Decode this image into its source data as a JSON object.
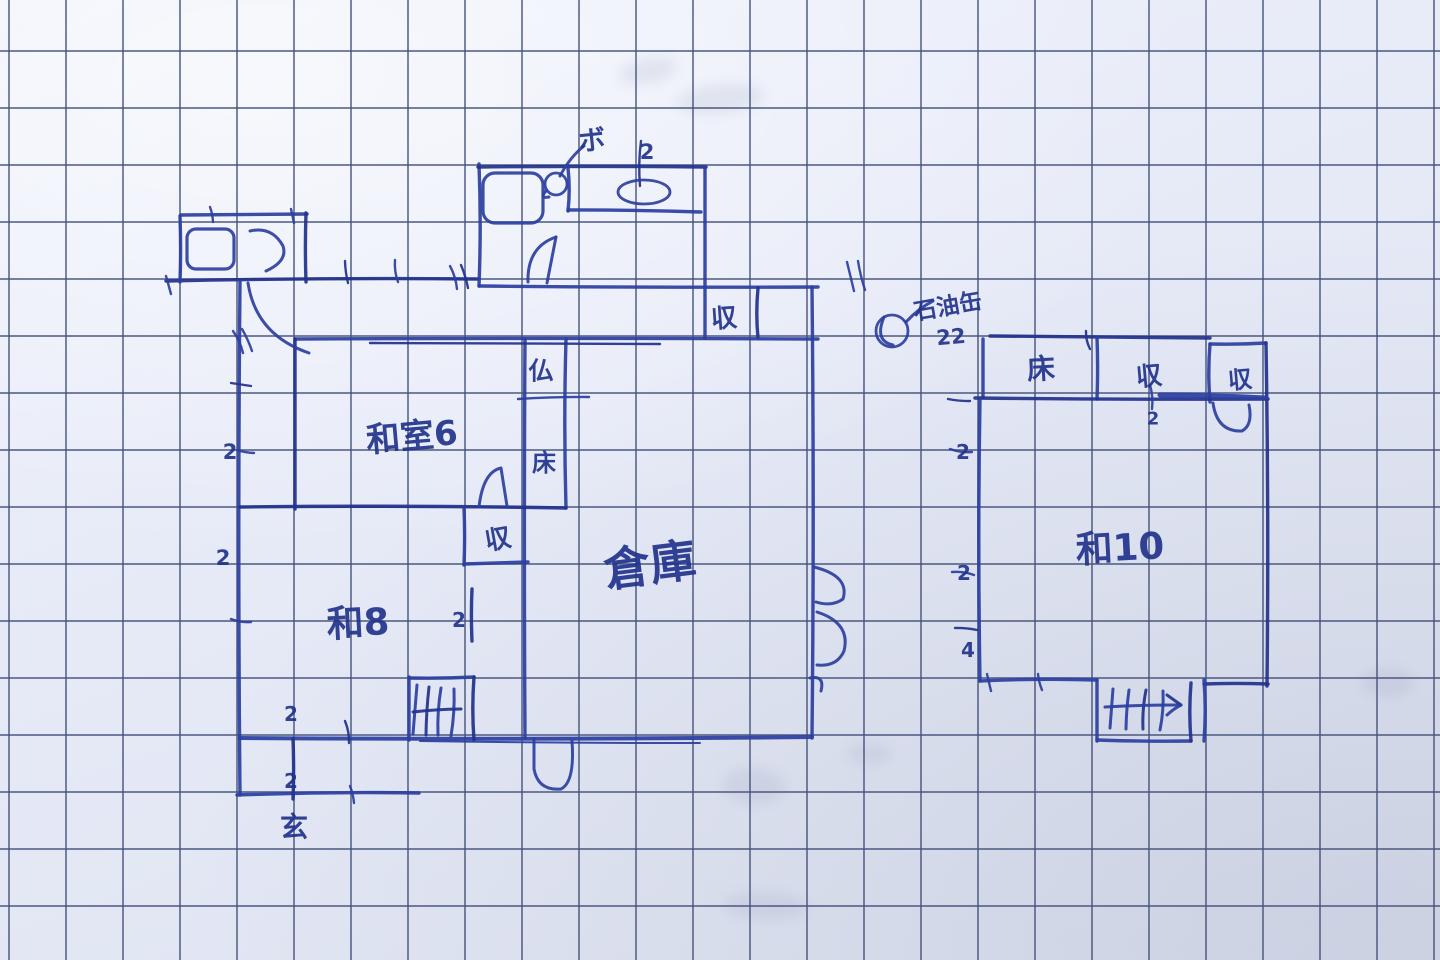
{
  "description": "Hand-drawn Japanese house floor plan sketched in blue ink on graph paper",
  "colors": {
    "ink": "#2c3fa0",
    "ink_dark": "#22338c",
    "grid": "#45527b",
    "bleed": "#8d98b6"
  },
  "grid": {
    "pitch": 57,
    "offset_x": 9,
    "offset_y": 51,
    "width": 1.7,
    "opacity": 0.82
  },
  "labels": [
    {
      "name": "boiler-note",
      "text": "ボ",
      "x": 592,
      "y": 141,
      "size": 27,
      "rot": -6
    },
    {
      "name": "dim-bath-top",
      "text": "2",
      "x": 647,
      "y": 152,
      "size": 21,
      "rot": 0
    },
    {
      "name": "closet-top-label",
      "text": "収",
      "x": 724,
      "y": 319,
      "size": 26,
      "rot": -4
    },
    {
      "name": "butsudan-label",
      "text": "仏",
      "x": 541,
      "y": 371,
      "size": 25,
      "rot": 0
    },
    {
      "name": "washitsu6-label",
      "text": "和室6",
      "x": 412,
      "y": 437,
      "size": 34,
      "rot": -5
    },
    {
      "name": "tokonoma-label",
      "text": "床",
      "x": 544,
      "y": 463,
      "size": 24,
      "rot": 0
    },
    {
      "name": "closet-mid-label",
      "text": "収",
      "x": 498,
      "y": 540,
      "size": 26,
      "rot": -10
    },
    {
      "name": "warehouse-label",
      "text": "倉庫",
      "x": 650,
      "y": 565,
      "size": 46,
      "rot": -7
    },
    {
      "name": "washitsu8-label",
      "text": "和8",
      "x": 358,
      "y": 623,
      "size": 37,
      "rot": -3
    },
    {
      "name": "dim-left-1",
      "text": "2",
      "x": 230,
      "y": 452,
      "size": 21,
      "rot": 0
    },
    {
      "name": "dim-left-2",
      "text": "2",
      "x": 223,
      "y": 558,
      "size": 21,
      "rot": 0
    },
    {
      "name": "dim-stair-left",
      "text": "2",
      "x": 459,
      "y": 620,
      "size": 20,
      "rot": 0
    },
    {
      "name": "dim-genkan-1",
      "text": "2",
      "x": 291,
      "y": 714,
      "size": 20,
      "rot": 0
    },
    {
      "name": "dim-genkan-2",
      "text": "2",
      "x": 291,
      "y": 781,
      "size": 20,
      "rot": 0
    },
    {
      "name": "genkan-label",
      "text": "玄",
      "x": 294,
      "y": 827,
      "size": 28,
      "rot": 0
    },
    {
      "name": "oilcan-note",
      "text": "石油缶",
      "x": 948,
      "y": 307,
      "size": 23,
      "rot": -10
    },
    {
      "name": "oilcan-qty",
      "text": "22",
      "x": 951,
      "y": 337,
      "size": 21,
      "rot": -5
    },
    {
      "name": "tokonoma-right-label",
      "text": "床",
      "x": 1041,
      "y": 369,
      "size": 28,
      "rot": -3
    },
    {
      "name": "closet-right1-label",
      "text": "収",
      "x": 1149,
      "y": 377,
      "size": 26,
      "rot": -5
    },
    {
      "name": "dim-closet-right",
      "text": "2",
      "x": 1153,
      "y": 419,
      "size": 18,
      "rot": 0
    },
    {
      "name": "closet-right2-label",
      "text": "収",
      "x": 1240,
      "y": 380,
      "size": 24,
      "rot": -5
    },
    {
      "name": "washitsu10-label",
      "text": "和10",
      "x": 1120,
      "y": 548,
      "size": 37,
      "rot": -3
    },
    {
      "name": "dim-right-1",
      "text": "2",
      "x": 963,
      "y": 452,
      "size": 20,
      "rot": 0
    },
    {
      "name": "dim-right-2",
      "text": "2",
      "x": 964,
      "y": 573,
      "size": 20,
      "rot": 0
    },
    {
      "name": "dim-right-3",
      "text": "4",
      "x": 968,
      "y": 650,
      "size": 20,
      "rot": 0
    }
  ],
  "sketch": {
    "walls": [
      [
        166,
        281,
        479,
        279
      ],
      [
        180,
        216,
        180,
        282
      ],
      [
        181,
        215,
        307,
        214
      ],
      [
        306,
        213,
        306,
        282
      ],
      [
        240,
        282,
        240,
        795
      ],
      [
        479,
        164,
        479,
        286
      ],
      [
        478,
        167,
        706,
        167
      ],
      [
        705,
        167,
        705,
        338
      ],
      [
        479,
        286,
        818,
        287
      ],
      [
        758,
        288,
        758,
        338
      ],
      [
        812,
        287,
        812,
        738
      ],
      [
        295,
        339,
        818,
        339
      ],
      [
        295,
        339,
        295,
        509
      ],
      [
        525,
        339,
        525,
        738
      ],
      [
        566,
        339,
        566,
        508
      ],
      [
        240,
        507,
        566,
        508
      ],
      [
        464,
        508,
        464,
        565
      ],
      [
        464,
        564,
        528,
        562
      ],
      [
        472,
        589,
        472,
        641
      ],
      [
        240,
        738,
        812,
        737,
        4
      ],
      [
        237,
        795,
        419,
        793
      ],
      [
        293,
        739,
        293,
        799
      ],
      [
        409,
        677,
        409,
        740
      ],
      [
        409,
        678,
        474,
        677
      ],
      [
        474,
        677,
        474,
        740
      ],
      [
        568,
        168,
        568,
        211
      ],
      [
        568,
        210,
        701,
        212
      ],
      [
        990,
        336,
        1210,
        338
      ],
      [
        1210,
        344,
        1266,
        343
      ],
      [
        1210,
        344,
        1210,
        402
      ],
      [
        1266,
        343,
        1267,
        686
      ],
      [
        1097,
        337,
        1097,
        399
      ],
      [
        983,
        339,
        983,
        397
      ],
      [
        975,
        398,
        1268,
        399
      ],
      [
        980,
        398,
        980,
        681
      ],
      [
        980,
        681,
        1097,
        680
      ],
      [
        1204,
        684,
        1268,
        684
      ],
      [
        1097,
        680,
        1097,
        741
      ],
      [
        1097,
        740,
        1191,
        741
      ],
      [
        1191,
        683,
        1191,
        741
      ],
      [
        1204,
        680,
        1204,
        741
      ],
      [
        1160,
        395,
        1266,
        398,
        5
      ],
      [
        370,
        343,
        660,
        344,
        2.4
      ],
      [
        420,
        741,
        700,
        743,
        2
      ]
    ],
    "ticks": [
      [
        210,
        207,
        213,
        222
      ],
      [
        291,
        209,
        294,
        223
      ],
      [
        345,
        261,
        348,
        283
      ],
      [
        395,
        260,
        398,
        282
      ],
      [
        450,
        266,
        457,
        289
      ],
      [
        461,
        265,
        468,
        288
      ],
      [
        847,
        262,
        854,
        291
      ],
      [
        858,
        261,
        865,
        290
      ],
      [
        641,
        141,
        640,
        186
      ],
      [
        233,
        331,
        243,
        353
      ],
      [
        242,
        329,
        252,
        351
      ],
      [
        231,
        383,
        251,
        386
      ],
      [
        237,
        450,
        254,
        453
      ],
      [
        231,
        619,
        251,
        622
      ],
      [
        345,
        721,
        349,
        743
      ],
      [
        350,
        786,
        354,
        803
      ],
      [
        166,
        276,
        171,
        294
      ],
      [
        948,
        399,
        970,
        401
      ],
      [
        950,
        449,
        972,
        452
      ],
      [
        952,
        572,
        974,
        575
      ],
      [
        955,
        628,
        977,
        630
      ],
      [
        987,
        674,
        991,
        691
      ],
      [
        1038,
        674,
        1042,
        690
      ],
      [
        1086,
        331,
        1090,
        349
      ],
      [
        1150,
        385,
        1152,
        409
      ],
      [
        518,
        399,
        589,
        397
      ]
    ],
    "hatches": [
      [
        417,
        685,
        413,
        734
      ],
      [
        429,
        687,
        426,
        735
      ],
      [
        441,
        688,
        438,
        735
      ],
      [
        454,
        689,
        451,
        736
      ],
      [
        413,
        712,
        461,
        709
      ],
      [
        1113,
        689,
        1110,
        728
      ],
      [
        1129,
        690,
        1126,
        729
      ],
      [
        1146,
        690,
        1143,
        729
      ],
      [
        1163,
        691,
        1160,
        730
      ],
      [
        1105,
        707,
        1181,
        705
      ],
      [
        1181,
        705,
        1167,
        695
      ],
      [
        1181,
        705,
        1167,
        715
      ]
    ],
    "paths": [
      {
        "name": "toilet-door-arc",
        "d": "M250,231 Q272,226 283,246 Q288,261 266,271"
      },
      {
        "name": "toilet-door-swing",
        "d": "M248,283 Q256,335 309,353"
      },
      {
        "name": "bath-door-arc",
        "d": "M556,237 Q527,247 528,282"
      },
      {
        "name": "bath-door-leaf",
        "d": "M556,237 L547,283"
      },
      {
        "name": "boiler-pointer",
        "d": "M560,176 Q570,157 584,146"
      },
      {
        "name": "boiler-curl",
        "d": "M546,191 Q539,199 549,197"
      },
      {
        "name": "washitsu6-door-arc",
        "d": "M479,507 Q483,472 501,468 L507,506"
      },
      {
        "name": "warehouse-door-arc-1",
        "d": "M814,567 Q850,576 843,599 Q832,607 816,602"
      },
      {
        "name": "warehouse-door-arc-2",
        "d": "M817,612 Q851,623 844,651 Q837,667 817,665"
      },
      {
        "name": "warehouse-door-mark",
        "d": "M810,678 Q825,675 821,691"
      },
      {
        "name": "bottom-door-arc",
        "d": "M534,739 L534,769 Q538,791 561,789 Q575,782 572,741"
      },
      {
        "name": "closet-right-door-arc",
        "d": "M1213,403 Q1217,432 1242,431 Q1253,425 1249,405"
      },
      {
        "name": "oilcan-pointer",
        "d": "M906,322 Q919,308 933,301"
      },
      {
        "name": "oilcan-curl",
        "d": "M884,317 Q874,341 893,345"
      }
    ],
    "rects": [
      {
        "name": "toilet-window",
        "x": 187,
        "y": 229,
        "w": 47,
        "h": 40,
        "r": 9
      },
      {
        "name": "bath-window",
        "x": 483,
        "y": 173,
        "w": 60,
        "h": 50,
        "r": 12
      }
    ],
    "circles": [
      {
        "name": "boiler-circle",
        "cx": 556,
        "cy": 184,
        "r": 11
      },
      {
        "name": "oilcan-circle",
        "cx": 892,
        "cy": 331,
        "r": 16
      }
    ],
    "ellipses": [
      {
        "name": "sink-bowl",
        "cx": 644,
        "cy": 192,
        "rx": 26,
        "ry": 12
      }
    ]
  },
  "bleed_marks": [
    [
      618,
      58,
      60,
      26,
      -12
    ],
    [
      676,
      84,
      88,
      30,
      -6
    ],
    [
      722,
      768,
      64,
      36,
      4
    ],
    [
      724,
      892,
      84,
      28,
      2
    ],
    [
      1362,
      668,
      52,
      30,
      0
    ],
    [
      846,
      744,
      46,
      20,
      0
    ]
  ]
}
